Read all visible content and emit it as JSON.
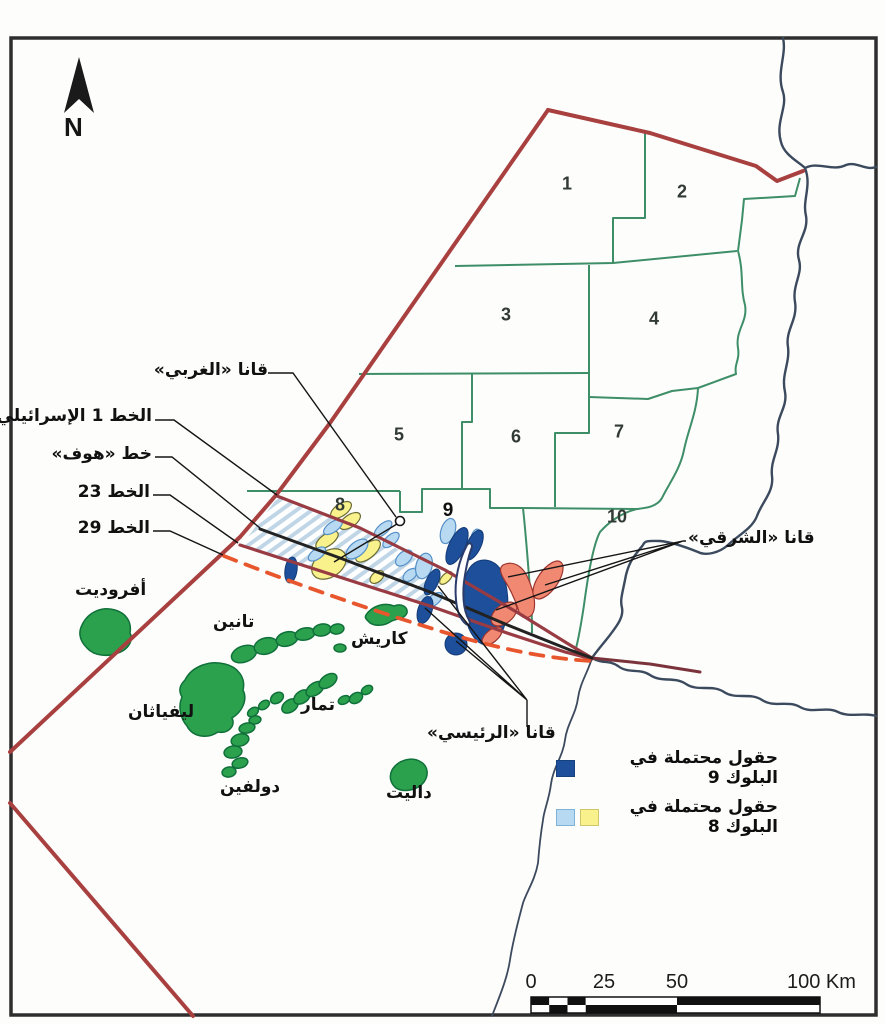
{
  "compass": {
    "label": "N"
  },
  "blocks": [
    {
      "number": "1"
    },
    {
      "number": "2"
    },
    {
      "number": "3"
    },
    {
      "number": "4"
    },
    {
      "number": "5"
    },
    {
      "number": "6"
    },
    {
      "number": "7"
    },
    {
      "number": "8"
    },
    {
      "number": "9"
    },
    {
      "number": "10"
    }
  ],
  "labels": {
    "qana_west": "قانا «الغربي»",
    "line_1": "الخط 1 الإسرائيلي",
    "hof": "خط «هوف»",
    "line_23": "الخط 23",
    "line_29": "الخط 29",
    "qana_east": "قانا «الشرقي»",
    "qana_main": "قانا «الرئيسي»"
  },
  "fields": {
    "aphrodite": "أفروديت",
    "tanin": "تانين",
    "leviathan": "ليفياثان",
    "tamar": "تمار",
    "dolphin": "دولفين",
    "dalit": "داليت",
    "karish": "كاريش"
  },
  "legend": {
    "items": [
      {
        "label": "حقول محتملة في البلوك 9",
        "swatches": [
          "#1d4f9b"
        ]
      },
      {
        "label": "حقول محتملة في البلوك 8",
        "swatches": [
          "#b7d9f1",
          "#f8f18c"
        ]
      }
    ]
  },
  "scale_bar": {
    "ticks": [
      "0",
      "25",
      "50"
    ],
    "end_label": "100 Km"
  },
  "colors": {
    "claim_border_red": "#a8403f",
    "line_1_and_23_maroon": "#993b42",
    "hof_line_black": "#222222",
    "line_29_dashed_orange": "#e8562e",
    "block_border_green": "#3e8e68",
    "coastline_navy": "#3c4a5e",
    "gas_field_green": "#2ba14e",
    "block8_field_yellow": "#f8f18c",
    "block8_field_lightblue": "#b7d9f1",
    "block9_field_darkblue": "#1d4f9b",
    "qana_east_salmon": "#f18972"
  }
}
